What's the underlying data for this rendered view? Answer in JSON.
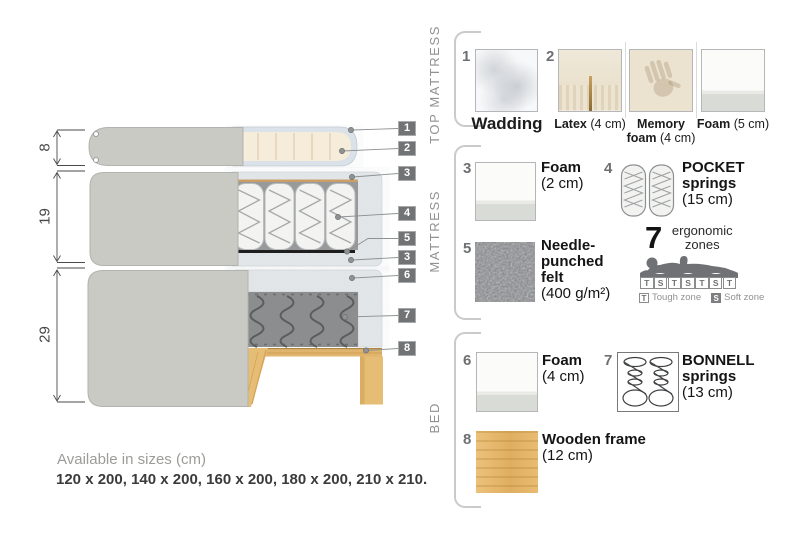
{
  "diagram": {
    "dimensions": [
      {
        "value": "8"
      },
      {
        "value": "19"
      },
      {
        "value": "29"
      }
    ],
    "callouts": [
      {
        "num": "1"
      },
      {
        "num": "2"
      },
      {
        "num": "3"
      },
      {
        "num": "4"
      },
      {
        "num": "5"
      },
      {
        "num": "3"
      },
      {
        "num": "6"
      },
      {
        "num": "7"
      },
      {
        "num": "8"
      }
    ]
  },
  "legend": {
    "sections": [
      {
        "label": "TOP MATTRESS"
      },
      {
        "label": "MATTRESS"
      },
      {
        "label": "BED"
      }
    ],
    "items": {
      "wadding": {
        "num": "1",
        "name": "Wadding",
        "size": ""
      },
      "latex": {
        "num": "2",
        "name": "Latex",
        "size": "(4 cm)"
      },
      "memory_foam": {
        "name": "Memory foam",
        "size": "(4 cm)"
      },
      "foam_top": {
        "name": "Foam",
        "size": "(5 cm)"
      },
      "foam_2": {
        "num": "3",
        "name": "Foam",
        "size": "(2 cm)"
      },
      "pocket": {
        "num": "4",
        "name": "POCKET springs",
        "size": "(15 cm)"
      },
      "felt": {
        "num": "5",
        "name": "Needle-punched felt",
        "size": "(400 g/m²)"
      },
      "foam_4": {
        "num": "6",
        "name": "Foam",
        "size": "(4 cm)"
      },
      "bonnell": {
        "num": "7",
        "name": "BONNELL springs",
        "size": "(13 cm)"
      },
      "wood": {
        "num": "8",
        "name": "Wooden frame",
        "size": "(12 cm)"
      }
    },
    "ergonomic": {
      "number": "7",
      "label": "ergonomic zones",
      "zones": [
        "T",
        "S",
        "T",
        "S",
        "T",
        "S",
        "T"
      ],
      "key": [
        {
          "letter": "T",
          "label": "Tough zone"
        },
        {
          "letter": "S",
          "label": "Soft zone"
        }
      ]
    }
  },
  "footer": {
    "title": "Available in sizes (cm)",
    "sizes": "120 x 200, 140 x 200, 160 x 200, 180 x 200, 210 x 210."
  },
  "colors": {
    "cover_gray": "#c9cac4",
    "foam_speckle": "#e3e7ea",
    "cream_foam": "#f6ecda",
    "spring_dark": "#8b8d8f",
    "wood": "#e3b96f",
    "callout_box": "#717375"
  }
}
